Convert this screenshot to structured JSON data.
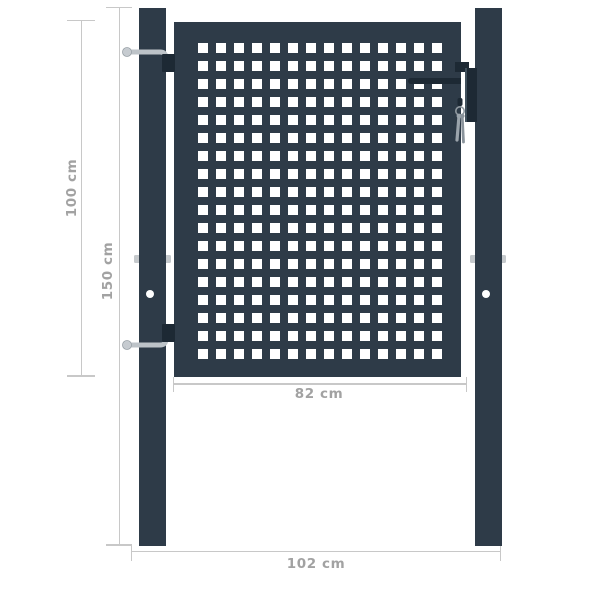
{
  "diagram": {
    "type": "product-dimension-diagram",
    "subject": "anthracite steel garden gate with square-perforated leaf and two posts",
    "labels": {
      "gate_height": "100 cm",
      "post_height": "150 cm",
      "leaf_width": "82 cm",
      "overall_width": "102 cm"
    },
    "colors": {
      "anthracite": "#2e3b48",
      "hardware_dark": "#1d2934",
      "metal_silver": "#bdc3c8",
      "dim_line": "#c8c8c8",
      "dim_text": "#a2a2a2",
      "hole": "#ffffff",
      "background": "#ffffff"
    },
    "perforation": {
      "columns": 14,
      "rows": 18
    }
  }
}
